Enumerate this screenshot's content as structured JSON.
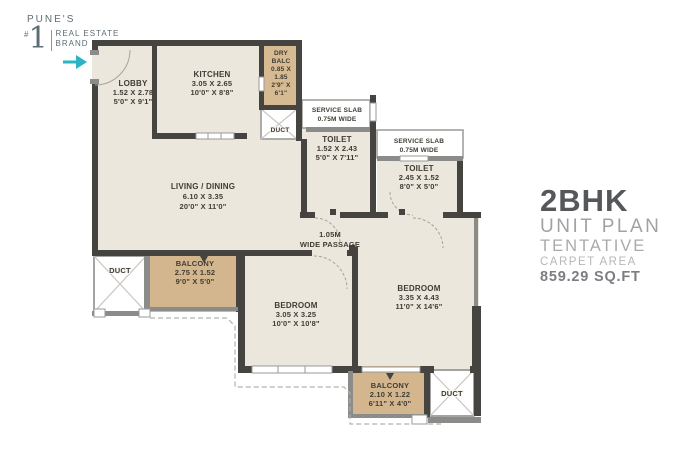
{
  "brand": {
    "city": "PUNE'S",
    "rank_hash": "#",
    "rank_number": "1",
    "line1": "REAL ESTATE",
    "line2": "BRAND"
  },
  "info": {
    "title": "2BHK",
    "line1": "UNIT PLAN",
    "line2": "TENTATIVE",
    "line3": "CARPET AREA",
    "area": "859.29 SQ.FT"
  },
  "rooms": {
    "lobby": {
      "name": "LOBBY",
      "metric": "1.52 X 2.78",
      "imperial": "5'0\" X 9'1\""
    },
    "kitchen": {
      "name": "KITCHEN",
      "metric": "3.05 X 2.65",
      "imperial": "10'0\" X 8'8\""
    },
    "dry_balcony": {
      "l1": "DRY",
      "l2": "BALC",
      "l3": "0.85 X",
      "l4": "1.85",
      "l5": "2'9\" X",
      "l6": "6'1\""
    },
    "duct_top": {
      "name": "DUCT"
    },
    "service_slab_1": {
      "l1": "SERVICE SLAB",
      "l2": "0.75M WIDE"
    },
    "toilet_1": {
      "name": "TOILET",
      "metric": "1.52 X 2.43",
      "imperial": "5'0\" X 7'11\""
    },
    "service_slab_2": {
      "l1": "SERVICE SLAB",
      "l2": "0.75M WIDE"
    },
    "toilet_2": {
      "name": "TOILET",
      "metric": "2.45 X 1.52",
      "imperial": "8'0\" X 5'0\""
    },
    "living_dining": {
      "name": "LIVING / DINING",
      "metric": "6.10 X 3.35",
      "imperial": "20'0\" X 11'0\""
    },
    "passage": {
      "l1": "1.05M",
      "l2": "WIDE PASSAGE"
    },
    "duct_left": {
      "name": "DUCT"
    },
    "balcony_left": {
      "name": "BALCONY",
      "metric": "2.75 X 1.52",
      "imperial": "9'0\" X 5'0\""
    },
    "bedroom_left": {
      "name": "BEDROOM",
      "metric": "3.05 X 3.25",
      "imperial": "10'0\" X 10'8\""
    },
    "bedroom_right": {
      "name": "BEDROOM",
      "metric": "3.35 X 4.43",
      "imperial": "11'0\" X 14'6\""
    },
    "balcony_bottom": {
      "name": "BALCONY",
      "metric": "2.10 X 1.22",
      "imperial": "6'11\" X 4'0\""
    },
    "duct_bottom": {
      "name": "DUCT"
    }
  },
  "colors": {
    "wall": "#454441",
    "room": "#ece7dc",
    "balcony": "#d3b68d",
    "teal": "#2bb3c6",
    "label": "#403c35"
  }
}
